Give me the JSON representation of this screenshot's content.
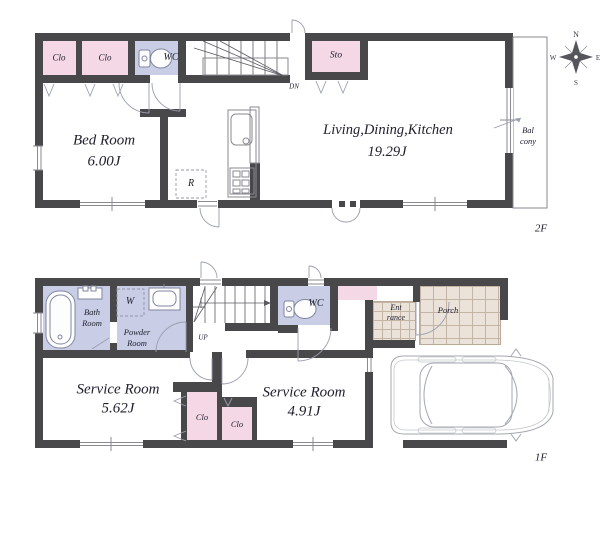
{
  "compass": {
    "north": "N",
    "east": "E",
    "south": "S",
    "west": "W"
  },
  "floor2": {
    "floor_label": "2F",
    "closet1": "Clo",
    "closet2": "Clo",
    "toilet": "WC",
    "storage": "Sto",
    "stairs": "DN",
    "bedroom_name": "Bed Room",
    "bedroom_size": "6.00J",
    "ldk_name": "Living,Dining,Kitchen",
    "ldk_size": "19.29J",
    "refrigerator": "R",
    "balcony_line1": "Bal",
    "balcony_line2": "cony"
  },
  "floor1": {
    "floor_label": "1F",
    "bath_line1": "Bath",
    "bath_line2": "Room",
    "washer": "W",
    "powder_line1": "Powder",
    "powder_line2": "Room",
    "stairs": "UP",
    "toilet": "WC",
    "entrance_line1": "Ent",
    "entrance_line2": "rance",
    "porch": "Porch",
    "service1_name": "Service Room",
    "service1_size": "5.62J",
    "service2_name": "Service Room",
    "service2_size": "4.91J",
    "closet1": "Clo",
    "closet2": "Clo"
  },
  "colors": {
    "wall": "#48484a",
    "closet_pink": "#f5d8e6",
    "wet_area_lavender": "#c9cee6",
    "tile": "#ebe3da",
    "tile_line": "#c3b4a4"
  }
}
